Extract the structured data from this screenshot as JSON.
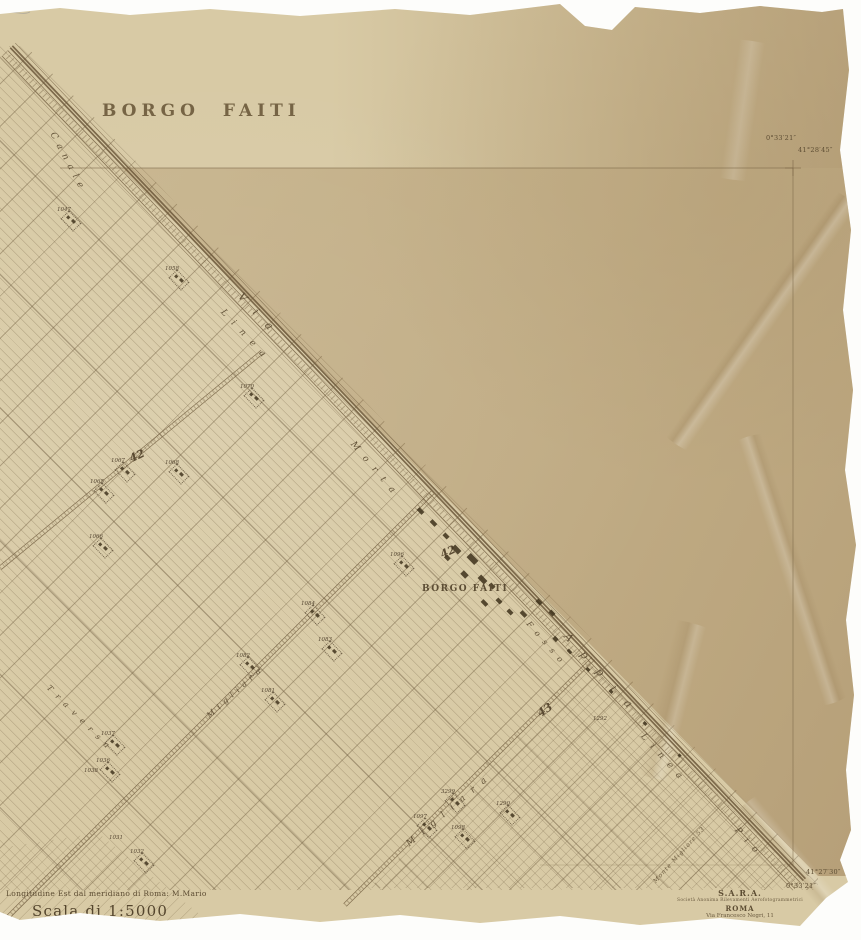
{
  "map": {
    "title": "BORGO FAITI",
    "village_label": "BORGO FAITI",
    "road_labels": [
      {
        "text": "Canale",
        "x": 52,
        "y": 128,
        "rot": 62,
        "ls": 6,
        "size": 9
      },
      {
        "text": "Via",
        "x": 240,
        "y": 288,
        "rot": 47,
        "ls": 14,
        "size": 11
      },
      {
        "text": "Linea",
        "x": 222,
        "y": 306,
        "rot": 47,
        "ls": 9,
        "size": 9
      },
      {
        "text": "Morta",
        "x": 352,
        "y": 438,
        "rot": 50,
        "ls": 9,
        "size": 9
      },
      {
        "text": "Fosso",
        "x": 528,
        "y": 618,
        "rot": 49,
        "ls": 7,
        "size": 8
      },
      {
        "text": "Appia",
        "x": 566,
        "y": 628,
        "rot": 48,
        "ls": 16,
        "size": 11
      },
      {
        "text": "Linea",
        "x": 642,
        "y": 730,
        "rot": 48,
        "ls": 8,
        "size": 9
      },
      {
        "text": "Pio",
        "x": 736,
        "y": 824,
        "rot": 48,
        "ls": 8,
        "size": 9
      },
      {
        "text": "Migliara",
        "x": 208,
        "y": 712,
        "rot": -42,
        "ls": 5,
        "size": 8
      },
      {
        "text": "Migliara",
        "x": 408,
        "y": 840,
        "rot": -40,
        "ls": 9,
        "size": 9
      },
      {
        "text": "Traversa",
        "x": 48,
        "y": 682,
        "rot": 45,
        "ls": 7,
        "size": 8
      }
    ],
    "road_numbers": [
      {
        "text": "42",
        "x": 137,
        "y": 456,
        "rot": -25
      },
      {
        "text": "42",
        "x": 448,
        "y": 552,
        "rot": -25
      },
      {
        "text": "43",
        "x": 545,
        "y": 710,
        "rot": -35
      }
    ],
    "parcel_numbers": [
      {
        "text": "1047",
        "x": 64,
        "y": 210,
        "b": 1
      },
      {
        "text": "1058",
        "x": 172,
        "y": 269,
        "b": 1
      },
      {
        "text": "1070",
        "x": 247,
        "y": 387,
        "b": 1
      },
      {
        "text": "1067",
        "x": 118,
        "y": 461,
        "b": 1
      },
      {
        "text": "1068",
        "x": 172,
        "y": 463,
        "b": 1
      },
      {
        "text": "1065",
        "x": 97,
        "y": 482,
        "b": 1
      },
      {
        "text": "1066",
        "x": 96,
        "y": 537,
        "b": 1
      },
      {
        "text": "1096",
        "x": 397,
        "y": 555,
        "b": 1
      },
      {
        "text": "1084",
        "x": 308,
        "y": 604,
        "b": 1
      },
      {
        "text": "1083",
        "x": 325,
        "y": 640,
        "b": 1
      },
      {
        "text": "1082",
        "x": 243,
        "y": 656,
        "b": 1
      },
      {
        "text": "1081",
        "x": 268,
        "y": 691,
        "b": 1
      },
      {
        "text": "1292",
        "x": 600,
        "y": 719,
        "b": 0
      },
      {
        "text": "3299",
        "x": 448,
        "y": 792,
        "b": 1
      },
      {
        "text": "1290",
        "x": 503,
        "y": 804,
        "b": 1
      },
      {
        "text": "1097",
        "x": 420,
        "y": 817,
        "b": 1
      },
      {
        "text": "1098",
        "x": 458,
        "y": 828,
        "b": 1
      },
      {
        "text": "1037",
        "x": 108,
        "y": 734,
        "b": 1
      },
      {
        "text": "1036",
        "x": 103,
        "y": 761,
        "b": 1
      },
      {
        "text": "1038",
        "x": 91,
        "y": 771,
        "b": 0
      },
      {
        "text": "1032",
        "x": 137,
        "y": 852,
        "b": 1
      },
      {
        "text": "1031",
        "x": 116,
        "y": 838,
        "b": 0
      }
    ],
    "buildings": [
      {
        "x": 417,
        "y": 509,
        "w": 7,
        "h": 4
      },
      {
        "x": 430,
        "y": 521,
        "w": 7,
        "h": 4
      },
      {
        "x": 443,
        "y": 534,
        "w": 6,
        "h": 4
      },
      {
        "x": 452,
        "y": 547,
        "w": 9,
        "h": 5
      },
      {
        "x": 467,
        "y": 556,
        "w": 11,
        "h": 6
      },
      {
        "x": 445,
        "y": 556,
        "w": 5,
        "h": 4
      },
      {
        "x": 461,
        "y": 572,
        "w": 7,
        "h": 5
      },
      {
        "x": 478,
        "y": 577,
        "w": 9,
        "h": 5
      },
      {
        "x": 489,
        "y": 584,
        "w": 6,
        "h": 4
      },
      {
        "x": 481,
        "y": 601,
        "w": 7,
        "h": 4
      },
      {
        "x": 496,
        "y": 599,
        "w": 6,
        "h": 4
      },
      {
        "x": 507,
        "y": 610,
        "w": 6,
        "h": 4
      },
      {
        "x": 520,
        "y": 612,
        "w": 7,
        "h": 4
      },
      {
        "x": 536,
        "y": 600,
        "w": 6,
        "h": 4
      },
      {
        "x": 549,
        "y": 611,
        "w": 6,
        "h": 4
      },
      {
        "x": 553,
        "y": 637,
        "w": 5,
        "h": 4
      },
      {
        "x": 567,
        "y": 650,
        "w": 5,
        "h": 3
      },
      {
        "x": 586,
        "y": 668,
        "w": 4,
        "h": 3
      },
      {
        "x": 609,
        "y": 690,
        "w": 4,
        "h": 3
      },
      {
        "x": 643,
        "y": 722,
        "w": 4,
        "h": 3
      },
      {
        "x": 678,
        "y": 754,
        "w": 3,
        "h": 3
      }
    ]
  },
  "margin": {
    "longitude_note": "Longitudine Est dal meridiano di Roma: M.Mario",
    "scale_label": "Scala di 1:5000",
    "corner_note": "Monte Migliore 53",
    "publisher": {
      "name": "S.A.R.A.",
      "subtitle": "Società Anonima Rilevamenti Aerofotogrammetrici",
      "city": "ROMA",
      "address": "Via Francesco Negri, 11"
    },
    "coords": {
      "top_right_lon": "0°33′21″",
      "top_right_lat": "41°28′45″",
      "bottom_right_lat": "41°27′30″",
      "bottom_right_lon": "0°33′21″"
    }
  }
}
